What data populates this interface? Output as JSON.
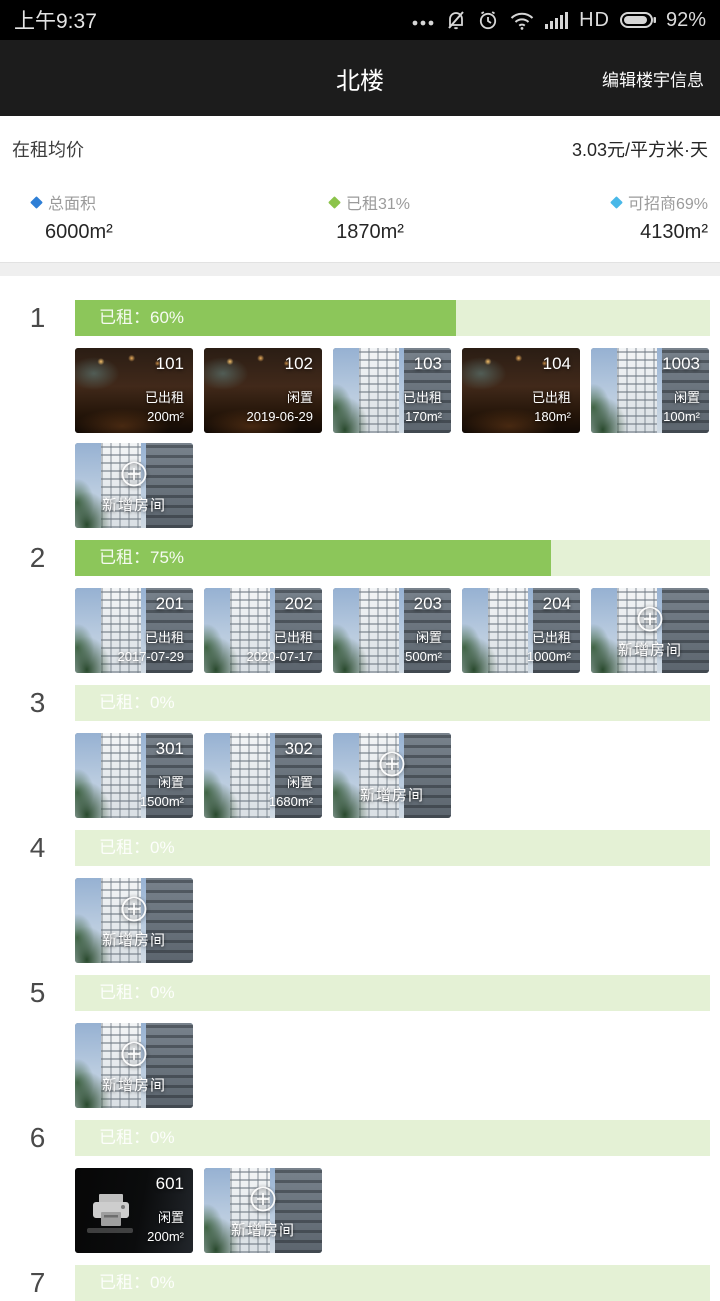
{
  "status_bar": {
    "time": "上午9:37",
    "network_label": "HD",
    "battery_percent": "92%"
  },
  "header": {
    "title": "北楼",
    "action": "编辑楼宇信息"
  },
  "summary": {
    "avg_label": "在租均价",
    "avg_value": "3.03元/平方米·天",
    "stats": [
      {
        "label": "总面积",
        "value": "6000m²",
        "diamond_color": "#2e7fd6"
      },
      {
        "label": "已租31%",
        "value": "1870m²",
        "diamond_color": "#8bc34a"
      },
      {
        "label": "可招商69%",
        "value": "4130m²",
        "diamond_color": "#49b8e8"
      }
    ]
  },
  "colors": {
    "bar_fill": "#8cc65a",
    "bar_track": "#e4f1d5"
  },
  "add_room_label": "新增房间",
  "floors": [
    {
      "number": "1",
      "label": "已租：60%",
      "percent": 60,
      "show_add": true,
      "rooms": [
        {
          "number": "101",
          "status": "已出租",
          "value": "200m²",
          "photo": "interior"
        },
        {
          "number": "102",
          "status": "闲置",
          "value": "2019-06-29",
          "photo": "interior"
        },
        {
          "number": "103",
          "status": "已出租",
          "value": "170m²",
          "photo": "building"
        },
        {
          "number": "104",
          "status": "已出租",
          "value": "180m²",
          "photo": "interior"
        },
        {
          "number": "1003",
          "status": "闲置",
          "value": "100m²",
          "photo": "building"
        }
      ]
    },
    {
      "number": "2",
      "label": "已租：75%",
      "percent": 75,
      "show_add": true,
      "rooms": [
        {
          "number": "201",
          "status": "已出租",
          "value": "2017-07-29",
          "photo": "building"
        },
        {
          "number": "202",
          "status": "已出租",
          "value": "2020-07-17",
          "photo": "building"
        },
        {
          "number": "203",
          "status": "闲置",
          "value": "500m²",
          "photo": "building"
        },
        {
          "number": "204",
          "status": "已出租",
          "value": "1000m²",
          "photo": "building"
        }
      ]
    },
    {
      "number": "3",
      "label": "已租：0%",
      "percent": 0,
      "show_add": true,
      "rooms": [
        {
          "number": "301",
          "status": "闲置",
          "value": "1500m²",
          "photo": "building"
        },
        {
          "number": "302",
          "status": "闲置",
          "value": "1680m²",
          "photo": "building"
        }
      ]
    },
    {
      "number": "4",
      "label": "已租：0%",
      "percent": 0,
      "show_add": true,
      "rooms": []
    },
    {
      "number": "5",
      "label": "已租：0%",
      "percent": 0,
      "show_add": true,
      "rooms": []
    },
    {
      "number": "6",
      "label": "已租：0%",
      "percent": 0,
      "show_add": true,
      "rooms": [
        {
          "number": "601",
          "status": "闲置",
          "value": "200m²",
          "photo": "dark"
        }
      ]
    },
    {
      "number": "7",
      "label": "已租：0%",
      "percent": 0,
      "show_add": false,
      "rooms": []
    }
  ]
}
